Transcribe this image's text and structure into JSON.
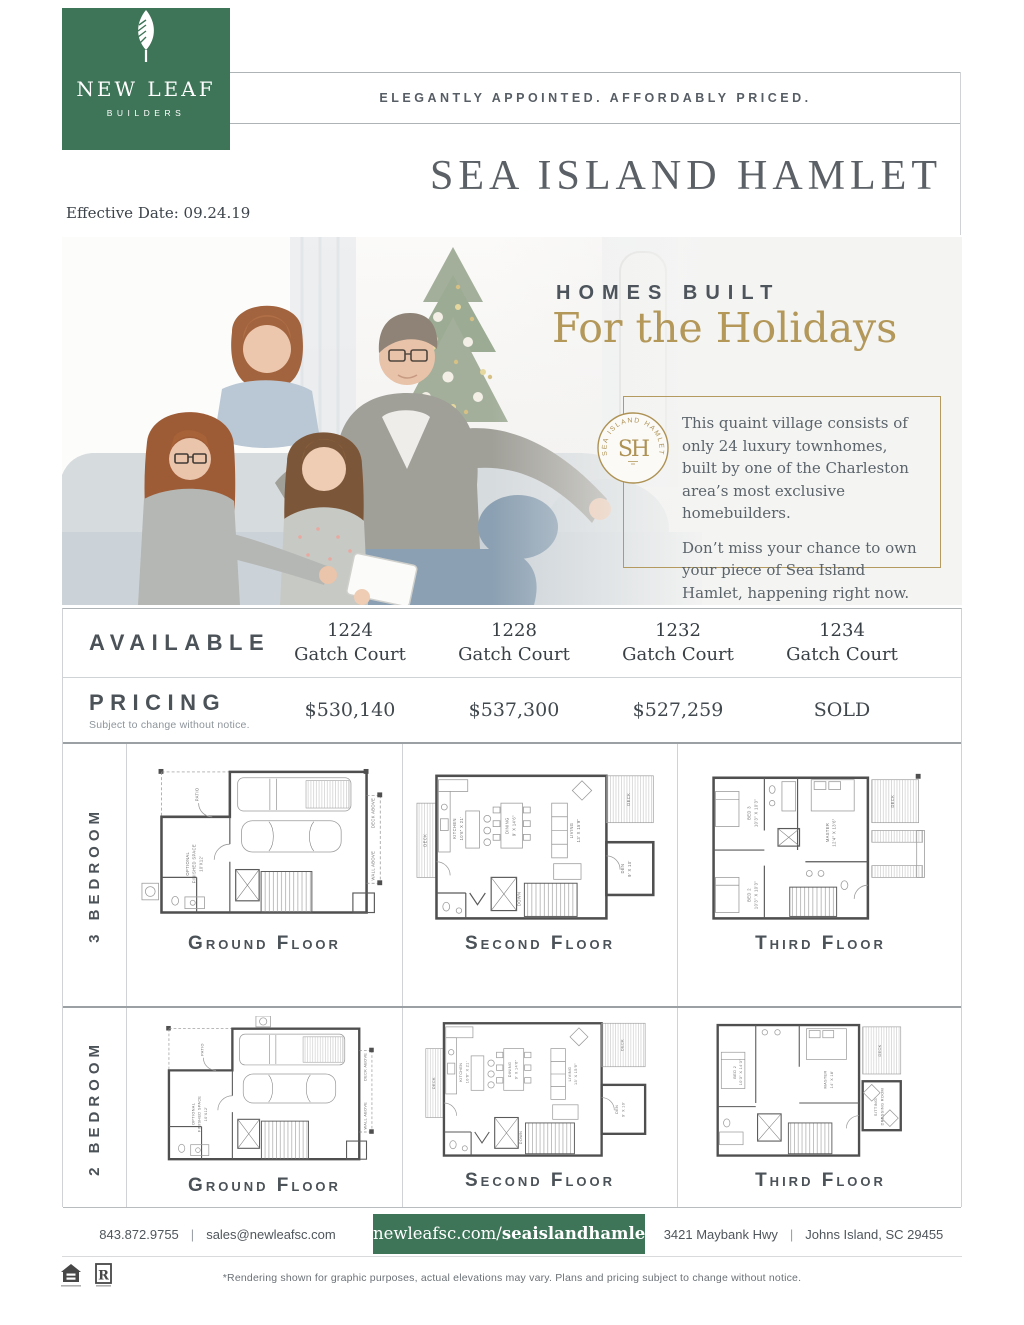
{
  "brand": {
    "name": "NEW LEAF",
    "descriptor": "BUILDERS",
    "tagline": "ELEGANTLY APPOINTED.  AFFORDABLY PRICED.",
    "green": "#3e7457",
    "gold": "#b3985a"
  },
  "header": {
    "title": "SEA ISLAND HAMLET",
    "effective_date": "Effective Date:  09.24.19"
  },
  "hero": {
    "kicker": "HOMES BUILT",
    "headline": "For the Holidays",
    "seal_text": "SEA ISLAND HAMLET",
    "seal_monogram": "SH",
    "body_1": "This quaint village consists of only 24 luxury townhomes, built by one of the Charleston area’s most exclusive homebuilders.",
    "body_2": "Don’t miss your chance to own your piece of Sea Island Hamlet, happening right now."
  },
  "availability": {
    "available_label": "AVAILABLE",
    "pricing_label": "PRICING",
    "pricing_note": "Subject to change without notice.",
    "units": [
      {
        "number": "1224",
        "street": "Gatch Court",
        "price": "$530,140"
      },
      {
        "number": "1228",
        "street": "Gatch Court",
        "price": "$537,300"
      },
      {
        "number": "1232",
        "street": "Gatch Court",
        "price": "$527,259"
      },
      {
        "number": "1234",
        "street": "Gatch Court",
        "price": "SOLD"
      }
    ]
  },
  "plans": {
    "row_3br_label": "3 BEDROOM",
    "row_2br_label": "2 BEDROOM",
    "captions": {
      "ground": "Ground Floor",
      "second": "Second Floor",
      "third": "Third Floor"
    },
    "labels": {
      "patio": "PATIO",
      "deck": "DECK",
      "deck_above": "DECK ABOVE",
      "wall_above": "WALL ABOVE",
      "optional_1": "OPTIONAL",
      "optional_2": "FINISHED SPACE",
      "optional_3": "10'X12'",
      "kitchen_1": "KITCHEN",
      "kitchen_2": "10'6\" X 21'",
      "dining_1": "DINING",
      "dining_2": "9' X 14'6\"",
      "living_1": "LIVING",
      "living_2": "13' X 15'9\"",
      "den_1": "DEN",
      "den_2": "9' X 10'",
      "down": "DOWN",
      "bed3_1": "BED 3",
      "bed3_2": "10'3\" X 10'3\"",
      "bed2_1": "BED 2",
      "bed2_2": "10'3\" X 10'3\"",
      "master3_1": "MASTER",
      "master3_2": "12'4\" X 13'6\"",
      "bed2b_1": "BED 2",
      "bed2b_2": "10'3\" X 14'3\"",
      "master2_1": "MASTER",
      "master2_2": "14' X 18'",
      "sitting_1": "SITTING/",
      "sitting_2": "DRESSING ROOM"
    }
  },
  "footer": {
    "phone": "843.872.9755",
    "separator": "|",
    "email": "sales@newleafsc.com",
    "url_normal": "newleafsc.com/",
    "url_bold": "seaislandhamlet",
    "address": "3421 Maybank Hwy",
    "city_state_zip": "Johns Island, SC 29455"
  },
  "legal": {
    "realtor_letter": "R",
    "disclaimer": "*Rendering shown for graphic purposes, actual elevations may vary.  Plans and pricing subject to change without notice."
  }
}
